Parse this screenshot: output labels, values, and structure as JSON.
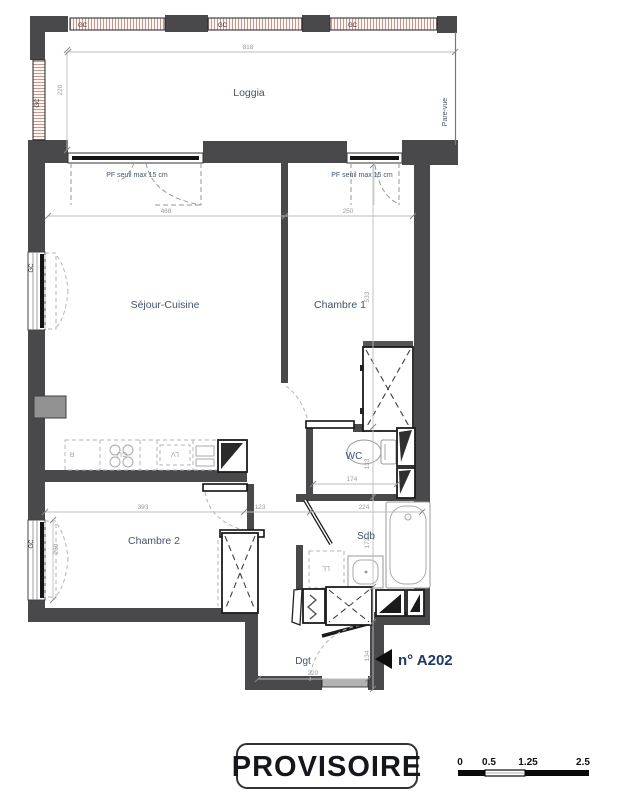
{
  "stamp": {
    "label": "PROVISOIRE"
  },
  "unit": {
    "number": "n° A202"
  },
  "rooms": {
    "loggia": "Loggia",
    "sejour": "Séjour-Cuisine",
    "chambre1": "Chambre 1",
    "chambre2": "Chambre 2",
    "wc": "WC",
    "sdb": "Sdb",
    "dgt": "Dgt"
  },
  "annotations": {
    "pf1": "PF seuil max 15 cm",
    "pf2": "PF seuil max 15 cm",
    "pare_vue": "Pare-vue",
    "gc": "GC"
  },
  "appliances": {
    "fridge": "R",
    "hob": "CU",
    "dishwasher": "LV",
    "washer": "LL"
  },
  "dimensions": {
    "loggia_width": "818",
    "loggia_depth": "220",
    "sejour_width": "468",
    "chambre1_width": "250",
    "chambre1_height": "533",
    "wc_height": "133",
    "sdb_height": "172",
    "dgt_height": "134",
    "wc_width": "174",
    "chambre2_width": "393",
    "hall_width": "123",
    "sdb_width": "224",
    "dgt_width": "220",
    "window2_height": "260"
  },
  "scale_bar": {
    "labels": [
      "0",
      "0.5",
      "1.25",
      "2.5"
    ]
  },
  "colors": {
    "wall": "#49494b",
    "room_label": "#44546a",
    "dimension": "#9a9a9a",
    "hatch_line": "#c49a90",
    "unit_label": "#1f3864"
  }
}
